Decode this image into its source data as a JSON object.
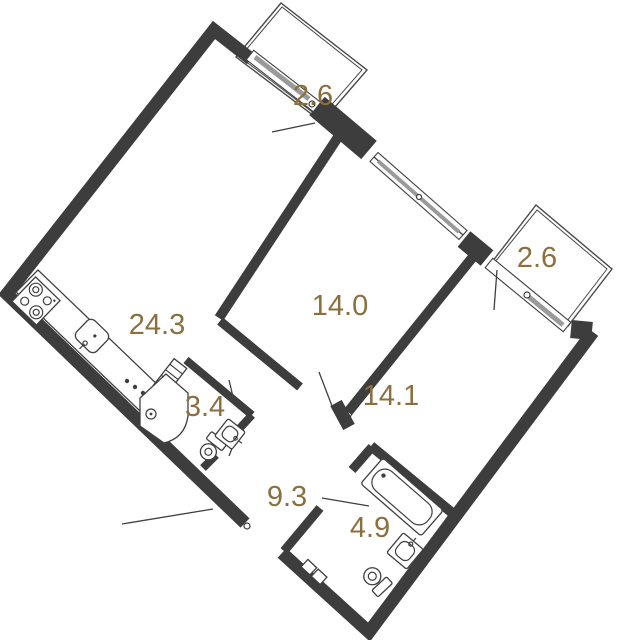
{
  "plan_type": "apartment-floor-plan",
  "colors": {
    "wall": "#3d3d3d",
    "label": "#8b6f3e",
    "thin_line": "#3f3f3f",
    "window_sash": "#9a9a9a",
    "background": "#ffffff"
  },
  "rooms": [
    {
      "name": "balcony-top",
      "area": "2.6"
    },
    {
      "name": "kitchen-living",
      "area": "24.3"
    },
    {
      "name": "bedroom-1",
      "area": "14.0"
    },
    {
      "name": "bedroom-2",
      "area": "14.1"
    },
    {
      "name": "bathroom-small",
      "area": "3.4"
    },
    {
      "name": "balcony-right",
      "area": "2.6"
    },
    {
      "name": "hallway",
      "area": "9.3"
    },
    {
      "name": "bathroom-large",
      "area": "4.9"
    }
  ]
}
